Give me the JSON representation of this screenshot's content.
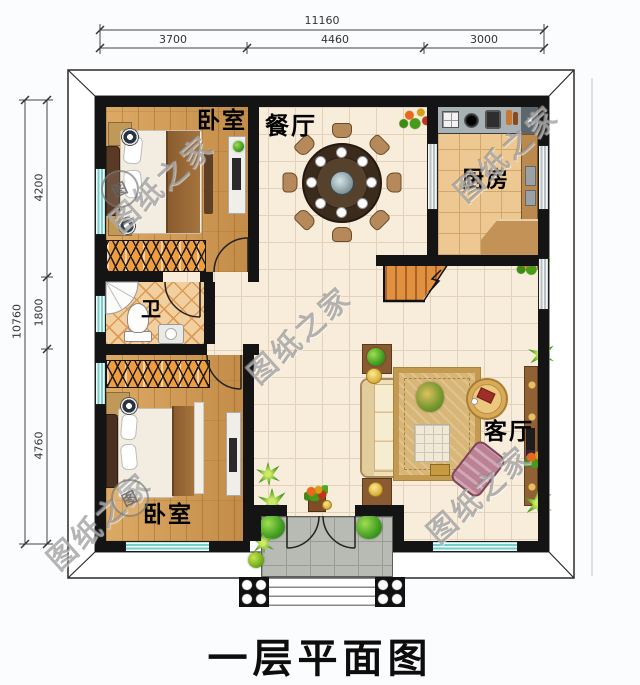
{
  "plan": {
    "title": "一层平面图",
    "watermark": "图纸之家",
    "stamp": "图",
    "rooms": {
      "bedroom1": "卧室",
      "dining": "餐厅",
      "kitchen": "厨房",
      "bathroom": "卫",
      "bedroom2": "卧室",
      "living": "客厅"
    },
    "dimensions": {
      "top_total": "11160",
      "top_segments": [
        "3700",
        "4460",
        "3000"
      ],
      "left_total": "10760",
      "left_segments": [
        "4200",
        "1800",
        "4760"
      ]
    },
    "colors": {
      "wall": "#141414",
      "window_teal": "#76cdcc",
      "wood_floor": "#d29d58",
      "tile_cream": "#f8ecdb",
      "kitchen_tile": "#eec892",
      "bath_tile": "#f2cf9e",
      "porch_gray": "#b7bbb3",
      "stair_wood": "#e09140"
    }
  }
}
